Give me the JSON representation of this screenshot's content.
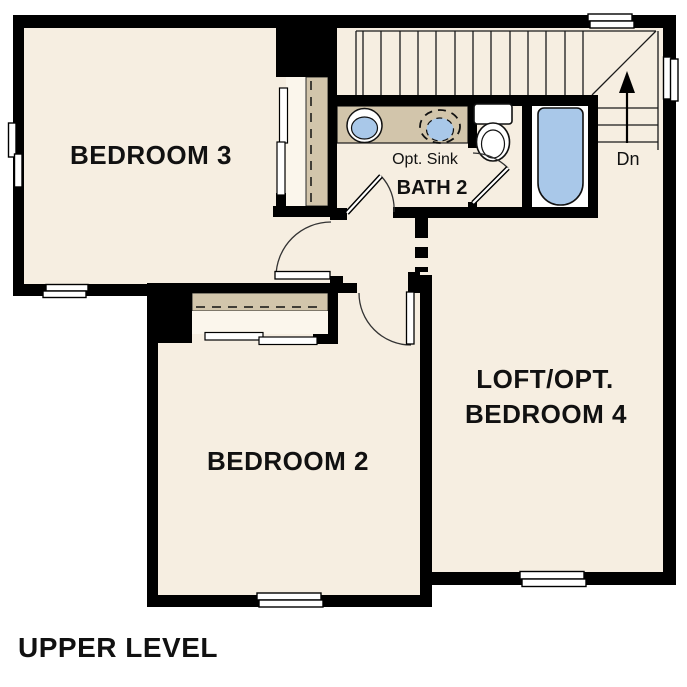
{
  "title": "UPPER LEVEL",
  "rooms": {
    "bedroom3": "BEDROOM 3",
    "bath2": "BATH 2",
    "bedroom2": "BEDROOM 2",
    "loft_line1": "LOFT/OPT.",
    "loft_line2": "BEDROOM 4"
  },
  "annotations": {
    "opt_sink": "Opt. Sink",
    "stairs_down": "Dn"
  },
  "palette": {
    "background": "#ffffff",
    "floor": "#f6eee1",
    "wall": "#000000",
    "counter": "#d2c5ab",
    "closet_interior": "#fbf6ec",
    "fixture_blue": "#a9c8e9",
    "fixture_white": "#ffffff",
    "line": "#1a1a1a"
  }
}
